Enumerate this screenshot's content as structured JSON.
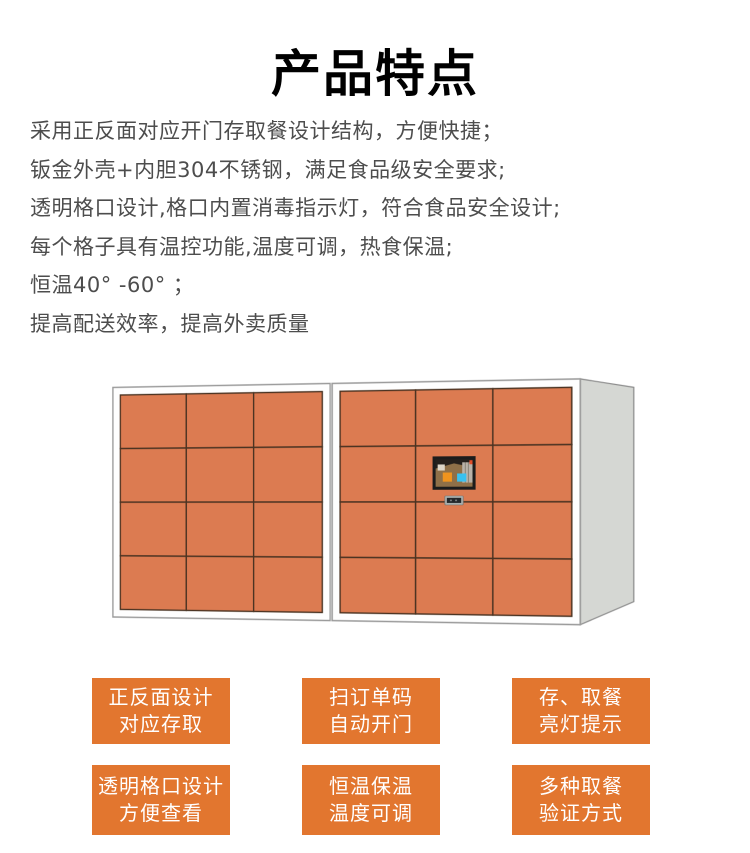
{
  "page": {
    "title": "产品特点"
  },
  "description": {
    "lines": [
      "采用正反面对应开门存取餐设计结构，方便快捷；",
      "钣金外壳+内胆304不锈钢，满足食品级安全要求;",
      "透明格口设计,格口内置消毒指示灯，符合食品安全设计;",
      "每个格子具有温控功能,温度可调，热食保温;",
      "恒温40° -60° ；",
      "提高配送效率，提高外卖质量"
    ]
  },
  "cabinet": {
    "label": "smart-food-delivery-locker",
    "colors": {
      "door": "#dc7b51",
      "door_line": "#4a3322",
      "frame": "#fefefe",
      "frame_stroke": "#9b9b9b",
      "side": "#d5d7d3",
      "side_stroke": "#8f8f8f",
      "screen_frame": "#1c1c1c",
      "screen_bg": "#8f7048",
      "screen_btn_orange": "#f0941e",
      "screen_btn_cyan": "#38c1ef",
      "scanner_body": "#aab0ae",
      "scanner_window": "#23282b"
    },
    "units": [
      {
        "cols": 3,
        "rows": 4,
        "has_screen": false
      },
      {
        "cols": 3,
        "rows": 4,
        "has_screen": true
      }
    ]
  },
  "feature_tags": {
    "bg_color": "#e2762f",
    "text_color": "#ffffff",
    "items": [
      {
        "line1": "正反面设计",
        "line2": "对应存取"
      },
      {
        "line1": "扫订单码",
        "line2": "自动开门"
      },
      {
        "line1": "存、取餐",
        "line2": "亮灯提示"
      },
      {
        "line1": "透明格口设计",
        "line2": "方便查看"
      },
      {
        "line1": "恒温保温",
        "line2": "温度可调"
      },
      {
        "line1": "多种取餐",
        "line2": "验证方式"
      }
    ]
  }
}
